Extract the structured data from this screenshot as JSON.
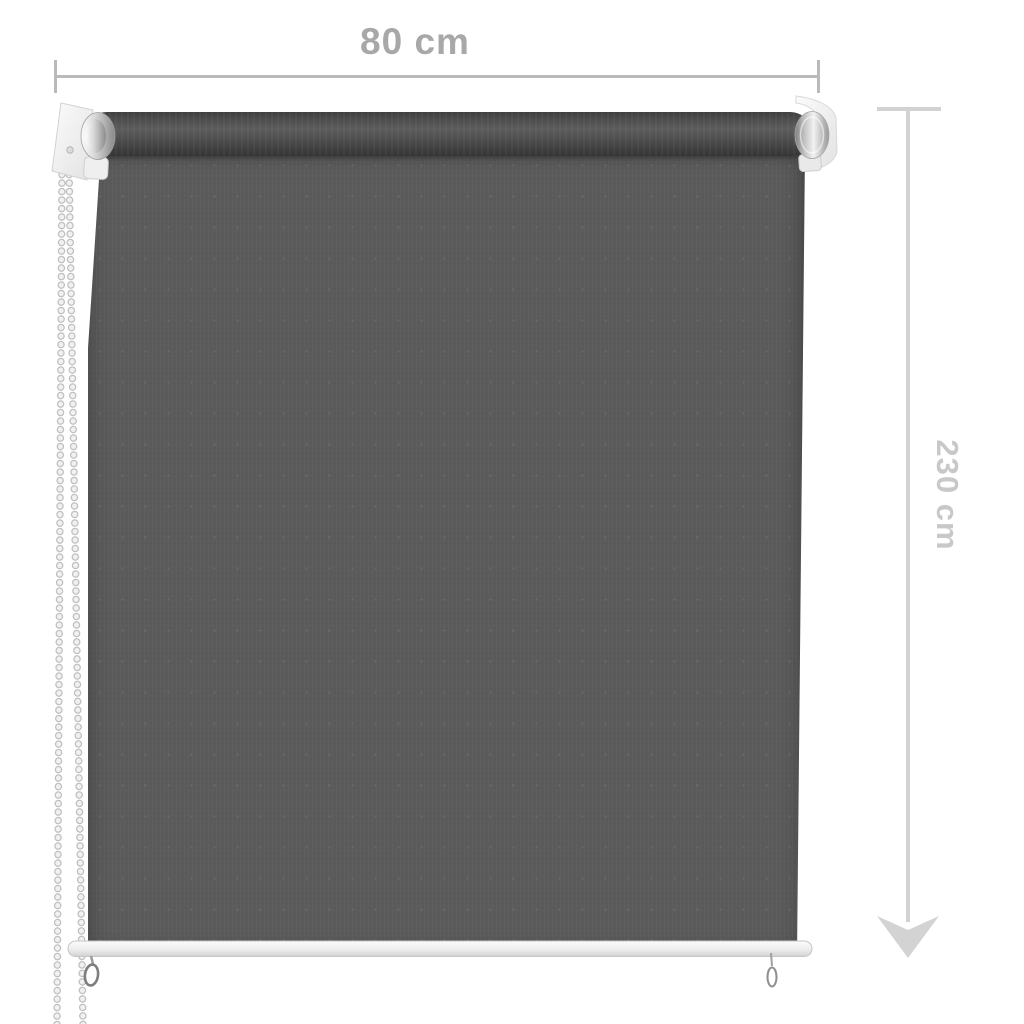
{
  "annotations": {
    "width_label": "80 cm",
    "height_label": "230 cm"
  },
  "colors": {
    "background": "#ffffff",
    "width_text": "#a8a8a8",
    "width_line": "#b9babc",
    "height_text": "#c8c8c8",
    "height_line": "#d2d2d2",
    "fabric": "#5b5b5b",
    "roll_dark": "#3f3f3f",
    "bar": "#f1f1f1",
    "metal": "#bdbdbd",
    "bracket": "#f5f5f5",
    "chain": "#f1f1f1"
  }
}
